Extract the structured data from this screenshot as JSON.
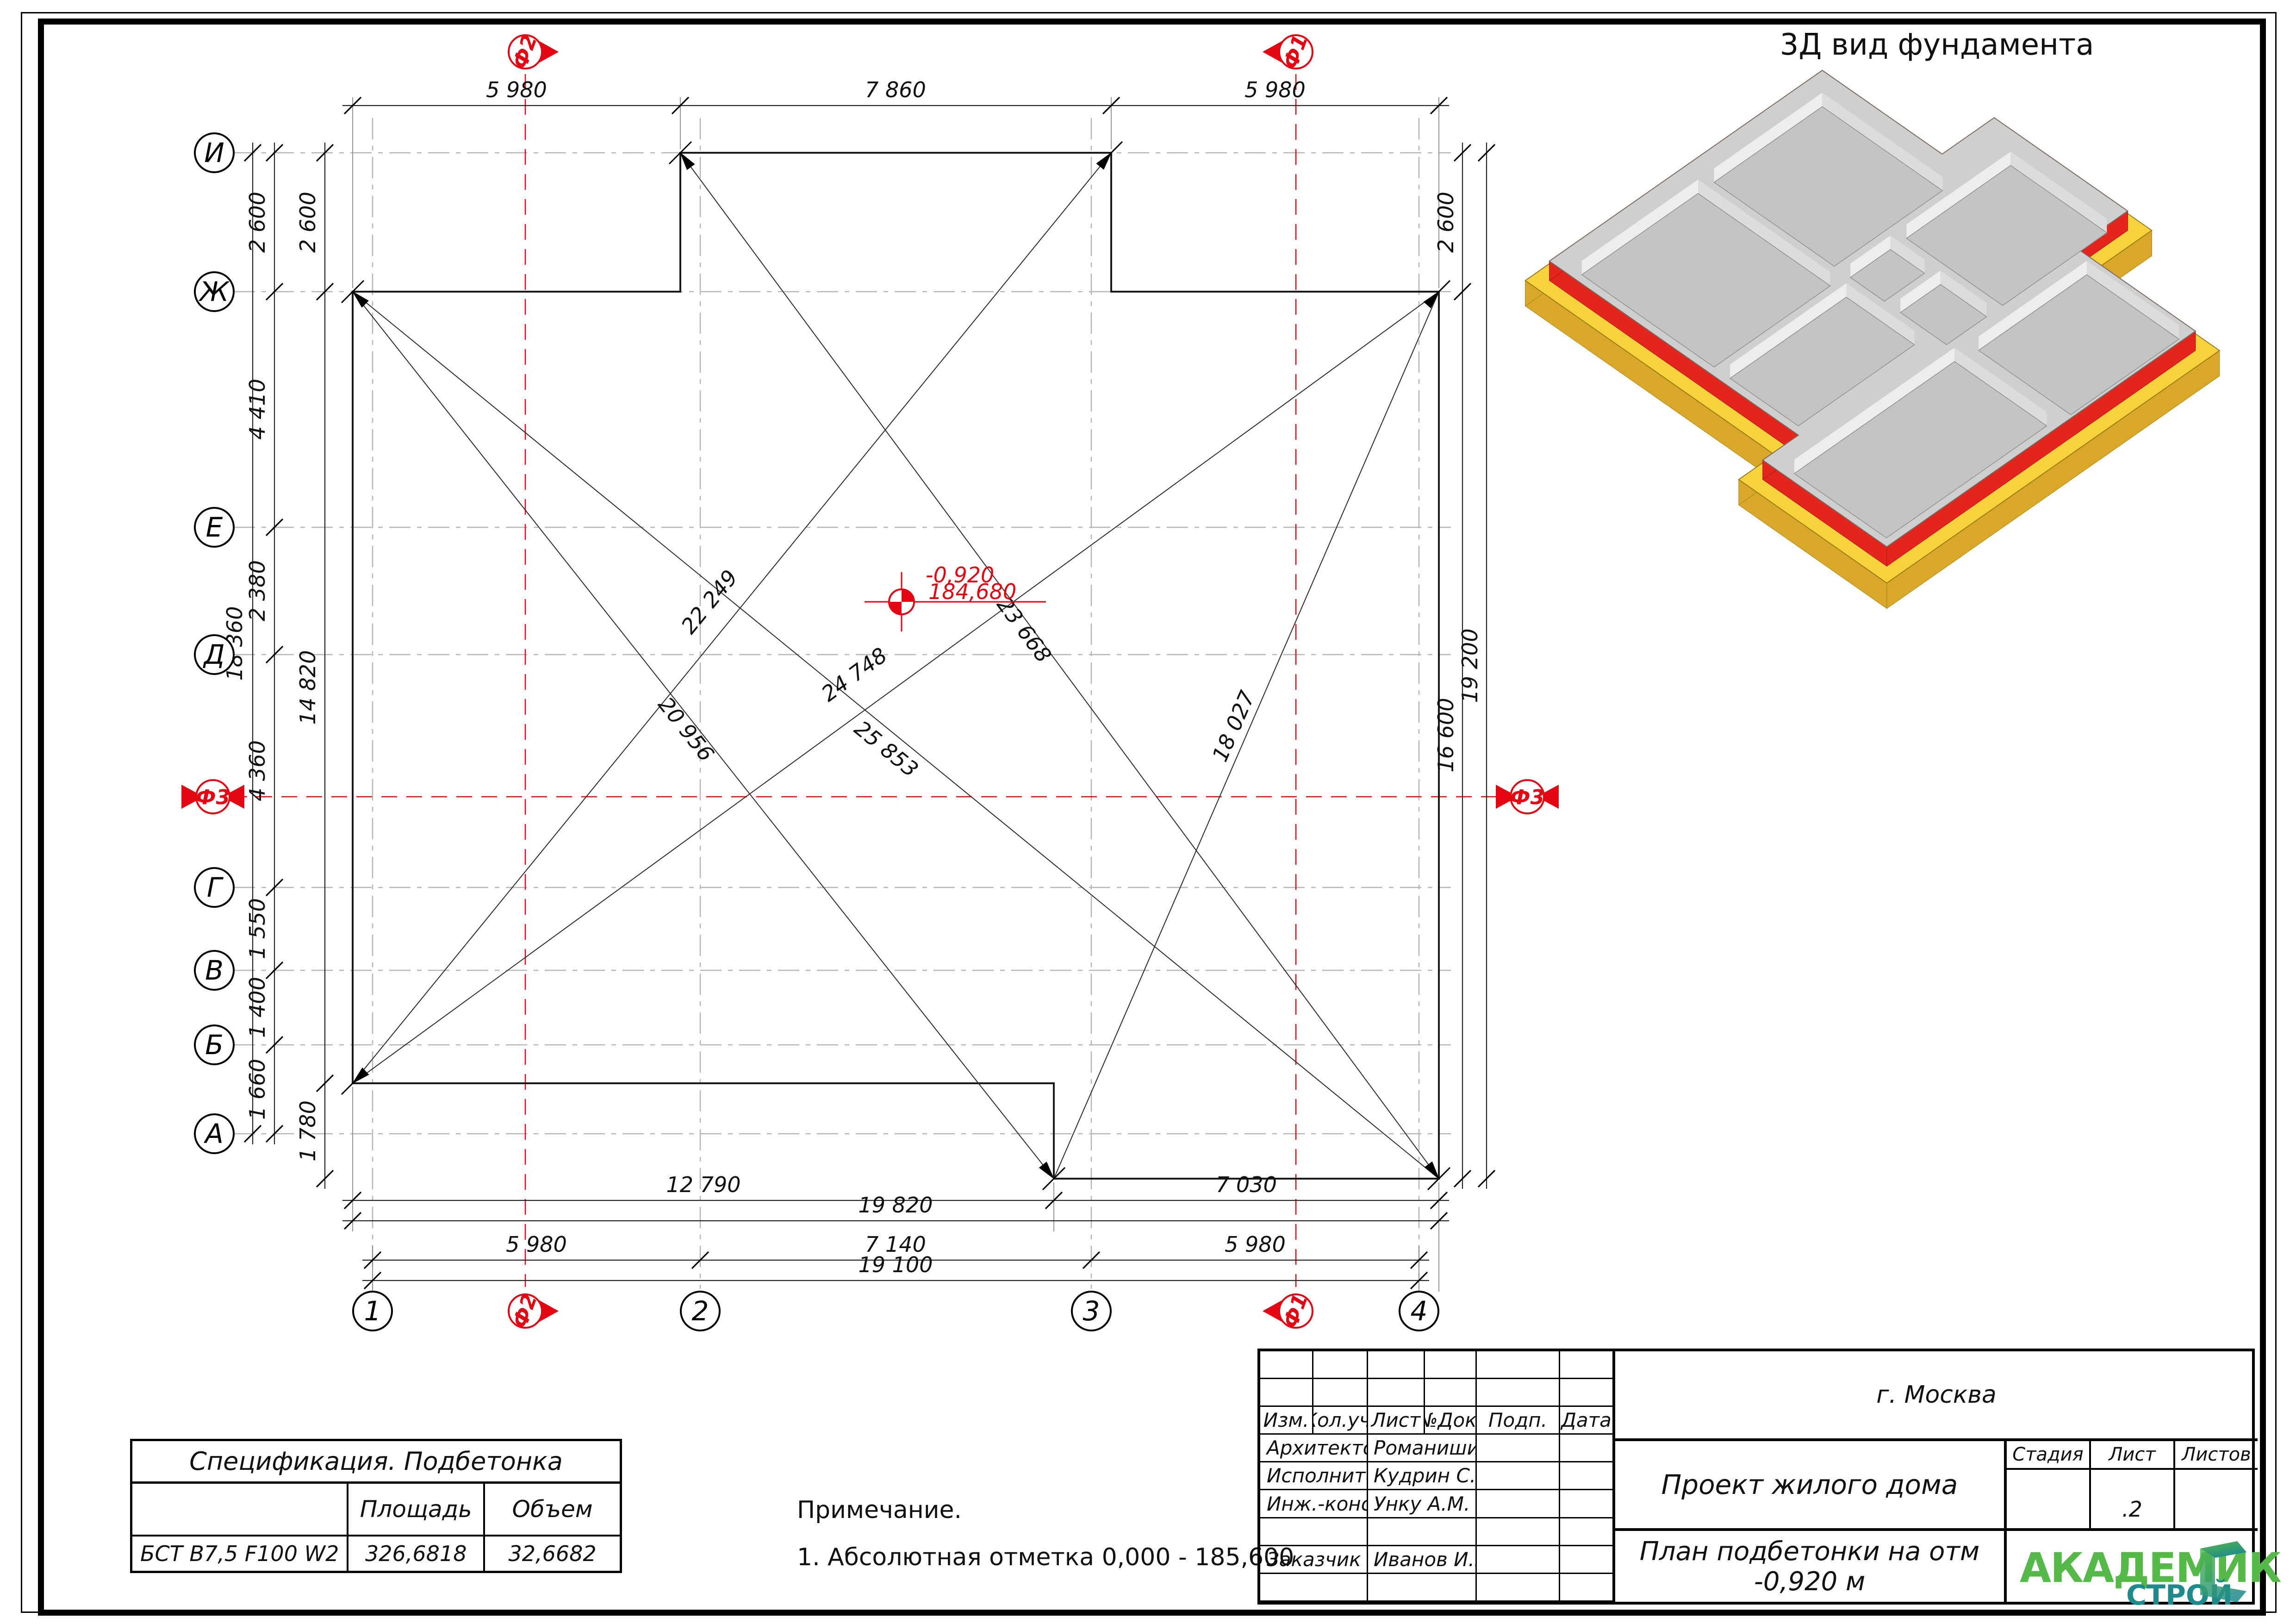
{
  "plan": {
    "axes_rows": [
      "И",
      "Ж",
      "Е",
      "Д",
      "Г",
      "В",
      "Б",
      "А"
    ],
    "axes_cols": [
      "1",
      "2",
      "3",
      "4"
    ],
    "sections": {
      "top_left": "Ф2",
      "top_right": "Ф1",
      "bottom_left": "Ф2",
      "bottom_right": "Ф1",
      "left": "Ф3",
      "right": "Ф3"
    },
    "dims": {
      "top": [
        "5 980",
        "7 860",
        "5 980"
      ],
      "left_total": "18 360",
      "left_segments": [
        "2 600",
        "4 410",
        "2 380",
        "4 360",
        "1 550",
        "1 400",
        "1 660"
      ],
      "left_inner": [
        "2 600",
        "14 820",
        "1 780"
      ],
      "right_inner": [
        "2 600",
        "16 600"
      ],
      "right_total": "19 200",
      "bottom_row1": [
        "12 790",
        "7 030"
      ],
      "bottom_row2": "19 820",
      "bottom_row3": [
        "5 980",
        "7 140",
        "5 980"
      ],
      "bottom_row4": "19 100",
      "diagonals": [
        "22 249",
        "23 668",
        "24 748",
        "25 853",
        "20 956",
        "18 027"
      ]
    },
    "level_mark": {
      "relative": "-0,920",
      "absolute": "184,680"
    }
  },
  "view3d": {
    "title": "3Д вид фундамента"
  },
  "spec_table": {
    "title": "Спецификация. Подбетонка",
    "columns": [
      "",
      "Площадь",
      "Объем"
    ],
    "rows": [
      [
        "БСТ В7,5 F100 W2",
        "326,6818",
        "32,6682"
      ]
    ]
  },
  "note": {
    "title": "Примечание.",
    "items": [
      "1. Абсолютная отметка 0,000 - 185,600"
    ]
  },
  "title_block": {
    "header": [
      "Изм.",
      "Кол.уч.",
      "Лист",
      "№Док.",
      "Подп.",
      "Дата"
    ],
    "rows": [
      {
        "role": "Архитектор",
        "name": "Романишин Д.М"
      },
      {
        "role": "Исполнитель",
        "name": "Кудрин С.В."
      },
      {
        "role": "Инж.-констр.",
        "name": "Унку А.М."
      },
      {
        "role": "Заказчик",
        "name": "Иванов И.И"
      }
    ],
    "city": "г. Москва",
    "project": "Проект жилого дома",
    "stage_header": [
      "Стадия",
      "Лист",
      "Листов"
    ],
    "sheet_no": ".2",
    "doc_title": "План подбетонки на отм -0,920 м",
    "logo": {
      "line1": "АКАДЕМИК",
      "line2": "СТРОЙ"
    }
  }
}
